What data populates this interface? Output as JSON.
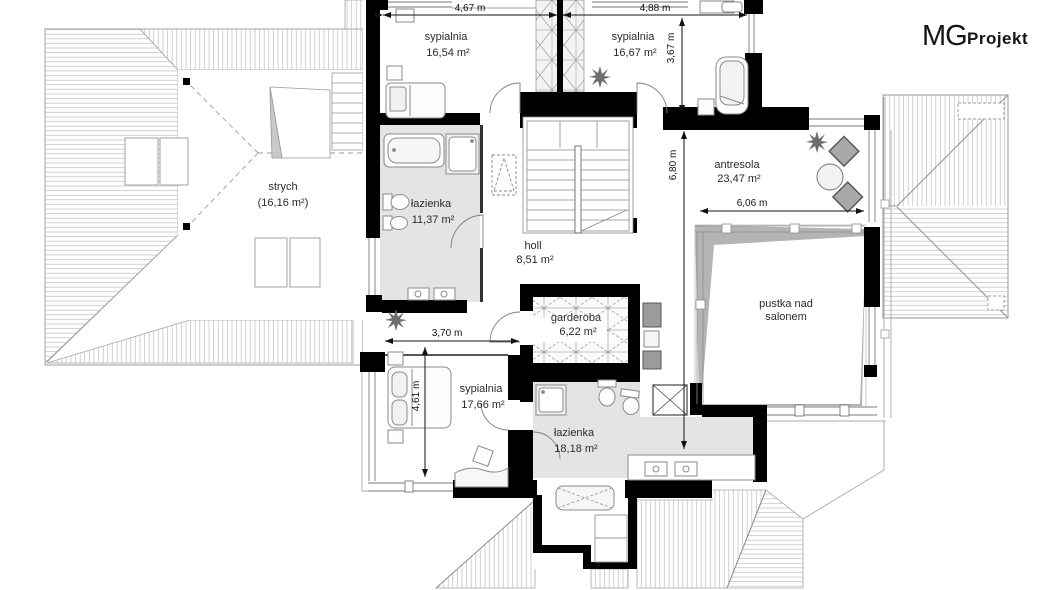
{
  "logo": {
    "mg": "MG",
    "projekt": "Projekt"
  },
  "rooms": {
    "sypialnia1": {
      "name": "sypialnia",
      "area": "16,54 m²"
    },
    "sypialnia2": {
      "name": "sypialnia",
      "area": "16,67 m²"
    },
    "strych": {
      "name": "strych",
      "area": "(16,16 m²)"
    },
    "lazienka1": {
      "name": "łazienka",
      "area": "11,37 m²"
    },
    "holl": {
      "name": "holl",
      "area": "8,51 m²"
    },
    "antresola": {
      "name": "antresola",
      "area": "23,47 m²"
    },
    "pustka": {
      "line1": "pustka nad",
      "line2": "salonem"
    },
    "garderoba": {
      "name": "garderoba",
      "area": "6,22 m²"
    },
    "sypialnia3": {
      "name": "sypialnia",
      "area": "17,66 m²"
    },
    "lazienka2": {
      "name": "łazienka",
      "area": "18,18 m²"
    }
  },
  "dimensions": {
    "d467": "4,67 m",
    "d488": "4,88 m",
    "d367": "3,67 m",
    "d680": "6,80 m",
    "d606": "6,06 m",
    "d370": "3,70 m",
    "d461": "4,61 m"
  },
  "colors": {
    "wall": "#000000",
    "bath_floor": "#e4e4e4",
    "void_shade": "#b4b4b4",
    "hatch": "#bdbdbd",
    "outline": "#999999",
    "text": "#2b2b2b"
  }
}
